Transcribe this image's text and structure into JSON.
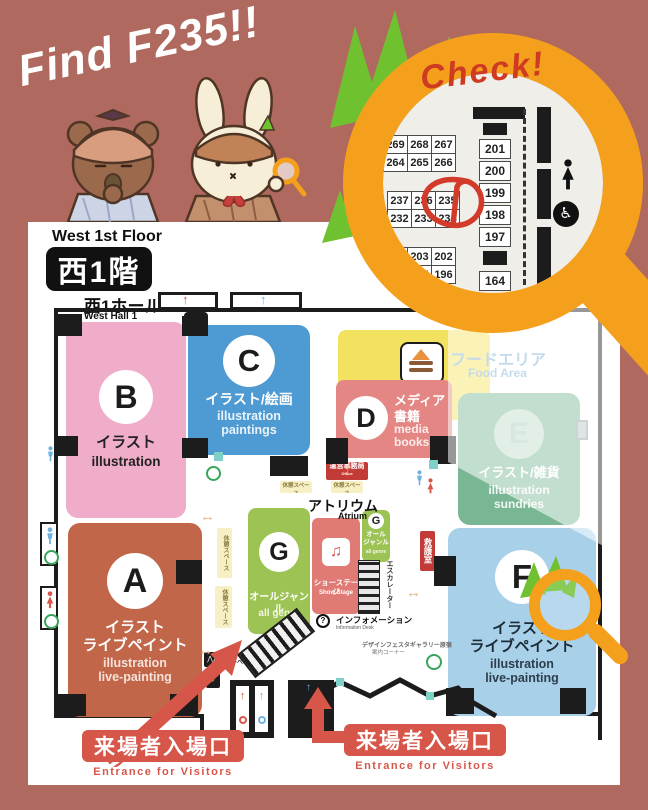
{
  "header": {
    "find_title": "Find F235!!",
    "check_label": "Check!"
  },
  "icons": {
    "wheelchair_glyph": "♿",
    "question_glyph": "?",
    "music_glyph": "♫",
    "up_arrow_glyph": "↑",
    "h_arrow_glyph": "↔",
    "v_arrow_glyph": "↕"
  },
  "lens": {
    "block1": {
      "r1": [
        "269",
        "268",
        "267"
      ],
      "r2": [
        "264",
        "265",
        "266"
      ]
    },
    "block2": {
      "r1": [
        "237",
        "236",
        "235"
      ],
      "r2": [
        "232",
        "233",
        "234"
      ]
    },
    "block3": {
      "r1": [
        "204",
        "203",
        "202"
      ],
      "r2": [
        "194",
        "195",
        "196"
      ]
    },
    "right_column": [
      "201",
      "200",
      "199",
      "198",
      "197",
      "164"
    ],
    "circled_booth": "235"
  },
  "map": {
    "floor_en": "West 1st Floor",
    "floor_jp": "西1階",
    "hall_jp": "西1ホール",
    "hall_en": "West Hall 1",
    "sections": {
      "A": {
        "letter": "A",
        "jp1": "イラスト",
        "jp2": "ライブペイント",
        "en1": "illustration",
        "en2": "live-painting"
      },
      "B": {
        "letter": "B",
        "jp1": "イラスト",
        "en1": "illustration"
      },
      "C": {
        "letter": "C",
        "jp1": "イラスト/絵画",
        "en1": "illustration",
        "en2": "paintings"
      },
      "D": {
        "letter": "D",
        "jp1": "メディア",
        "jp2": "書籍",
        "en1": "media",
        "en2": "books"
      },
      "E": {
        "letter": "E",
        "jp1": "イラスト/雑貨",
        "en1": "illustration",
        "en2": "sundries"
      },
      "F": {
        "letter": "F",
        "jp1": "イラスト",
        "jp2": "ライブペイント",
        "en1": "illustration",
        "en2": "live-painting"
      },
      "G": {
        "letter": "G",
        "jp1": "オールジャンル",
        "en1": "all genre"
      },
      "G2": {
        "letter": "G",
        "jp1": "オール",
        "jp2": "ジャンル",
        "en1": "all genre"
      }
    },
    "labels": {
      "atrium_jp": "アトリウム",
      "atrium_en": "Atrium",
      "food_jp": "フードエリア",
      "food_en": "Food Area",
      "stage_jp": "ショーステージ",
      "stage_en": "Show Stage",
      "office_jp": "運営事務局",
      "office_en": "Office",
      "first_aid_jp": "救護室",
      "info_jp": "インフォメーション",
      "info_en": "Information Desk",
      "escalator_jp": "エスカレーター",
      "elevator_jp": "エレベーター",
      "rest_jp": "休憩スペース",
      "rest_en": "Rest Space",
      "gallery_note1": "デザインフェスタギャラリー原宿",
      "gallery_note2": "案内コーナー",
      "entrance_jp": "来場者入場口",
      "entrance_en": "Entrance for Visitors"
    }
  },
  "colors": {
    "background": "#b0695e",
    "magnifier": "#f5a01d",
    "leaf": "#6fc130",
    "check_red": "#cf3a22",
    "entrance_red": "#d6564a",
    "section_a": "#c2664a",
    "section_b": "#f0adca",
    "section_c": "#4e9ad2",
    "section_d": "#e48784",
    "section_e": "#79b694",
    "section_f": "#a8d0e9",
    "section_g": "#9dc355",
    "stage": "#e07a74",
    "food_yellow": "#f3e25f"
  }
}
